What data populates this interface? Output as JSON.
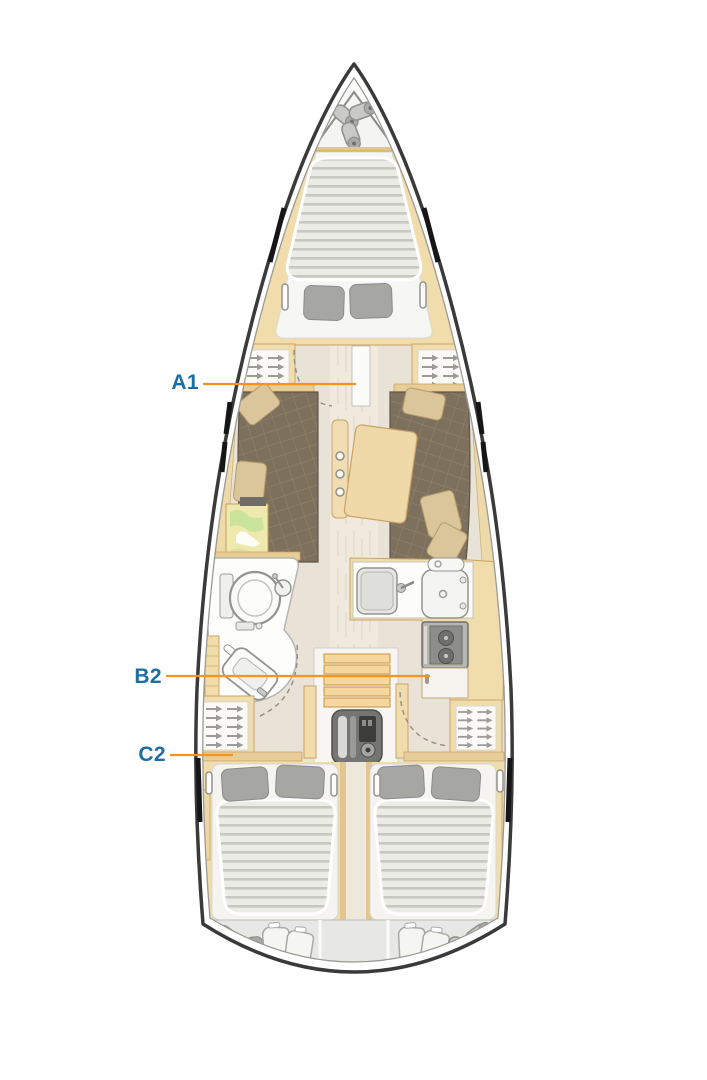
{
  "diagram": {
    "type": "sailing-yacht-interior-layout-plan",
    "orientation": "bow-up",
    "areas": [
      "anchor-locker",
      "forward-cabin",
      "wardrobes",
      "salon",
      "dining-table",
      "chart-table",
      "galley",
      "head-bathroom",
      "companionway-steps",
      "engine",
      "aft-cabin-port",
      "aft-cabin-starboard",
      "stern-lockers"
    ]
  },
  "colors": {
    "label_blue": "#1c6fa0",
    "callout_orange": "#f2941e"
  },
  "labels": {
    "a1": "A1",
    "b2": "B2",
    "c2": "C2"
  }
}
